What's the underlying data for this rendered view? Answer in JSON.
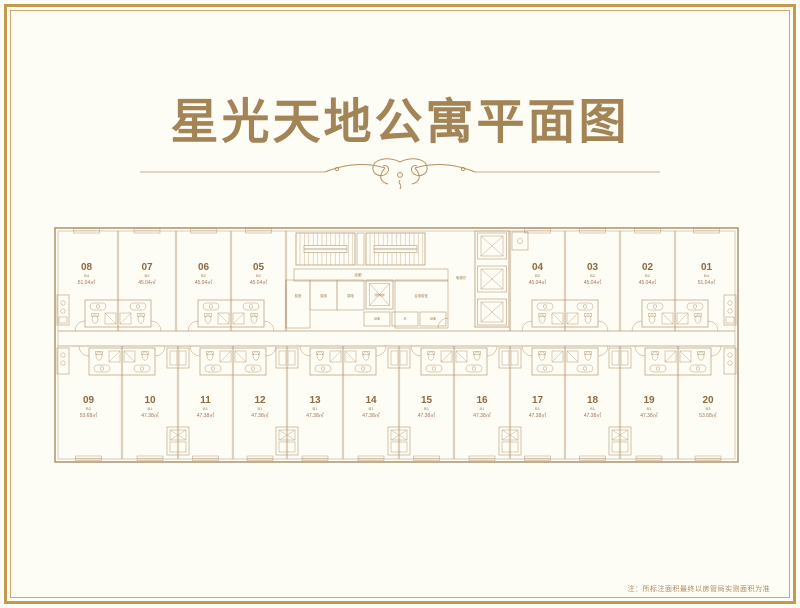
{
  "title": "星光天地公寓平面图",
  "note": "注：所标注面积最终以房管局实测面积为准",
  "colors": {
    "frame_gold": "#c5994f",
    "title_gold": "#a28457",
    "plan_line": "#b79b76",
    "unit_number": "#8c6a42",
    "unit_area": "#a5705a",
    "background": "#fdfcf5"
  },
  "floor_plan": {
    "area_suffix": "㎡",
    "top_units": [
      {
        "no": "08",
        "type": "B4",
        "area": "51.04"
      },
      {
        "no": "07",
        "type": "B2",
        "area": "45.04"
      },
      {
        "no": "06",
        "type": "B2",
        "area": "45.04"
      },
      {
        "no": "05",
        "type": "B2",
        "area": "45.04"
      },
      {
        "no": "04",
        "type": "B2",
        "area": "45.04"
      },
      {
        "no": "03",
        "type": "B2",
        "area": "45.04"
      },
      {
        "no": "02",
        "type": "B2",
        "area": "45.04"
      },
      {
        "no": "01",
        "type": "B4",
        "area": "51.04"
      }
    ],
    "bottom_units": [
      {
        "no": "09",
        "type": "B3",
        "area": "53.68"
      },
      {
        "no": "10",
        "type": "B1",
        "area": "47.38"
      },
      {
        "no": "11",
        "type": "B1",
        "area": "47.38"
      },
      {
        "no": "12",
        "type": "B1",
        "area": "47.38"
      },
      {
        "no": "13",
        "type": "B1",
        "area": "47.38"
      },
      {
        "no": "14",
        "type": "B1",
        "area": "47.38"
      },
      {
        "no": "15",
        "type": "B1",
        "area": "47.38"
      },
      {
        "no": "16",
        "type": "B1",
        "area": "47.38"
      },
      {
        "no": "17",
        "type": "B1",
        "area": "47.38"
      },
      {
        "no": "18",
        "type": "B1",
        "area": "47.38"
      },
      {
        "no": "19",
        "type": "B1",
        "area": "47.38"
      },
      {
        "no": "20",
        "type": "B3",
        "area": "53.68"
      }
    ],
    "core": {
      "corridor": "走廊",
      "front_room": "前室",
      "strong_power": "强电",
      "weak_power": "弱电",
      "fire_elevator": "消防电梯",
      "shared_front_room": "合用前室",
      "equipment": "设备",
      "water": "水",
      "elevator_hall": "电梯厅"
    }
  }
}
